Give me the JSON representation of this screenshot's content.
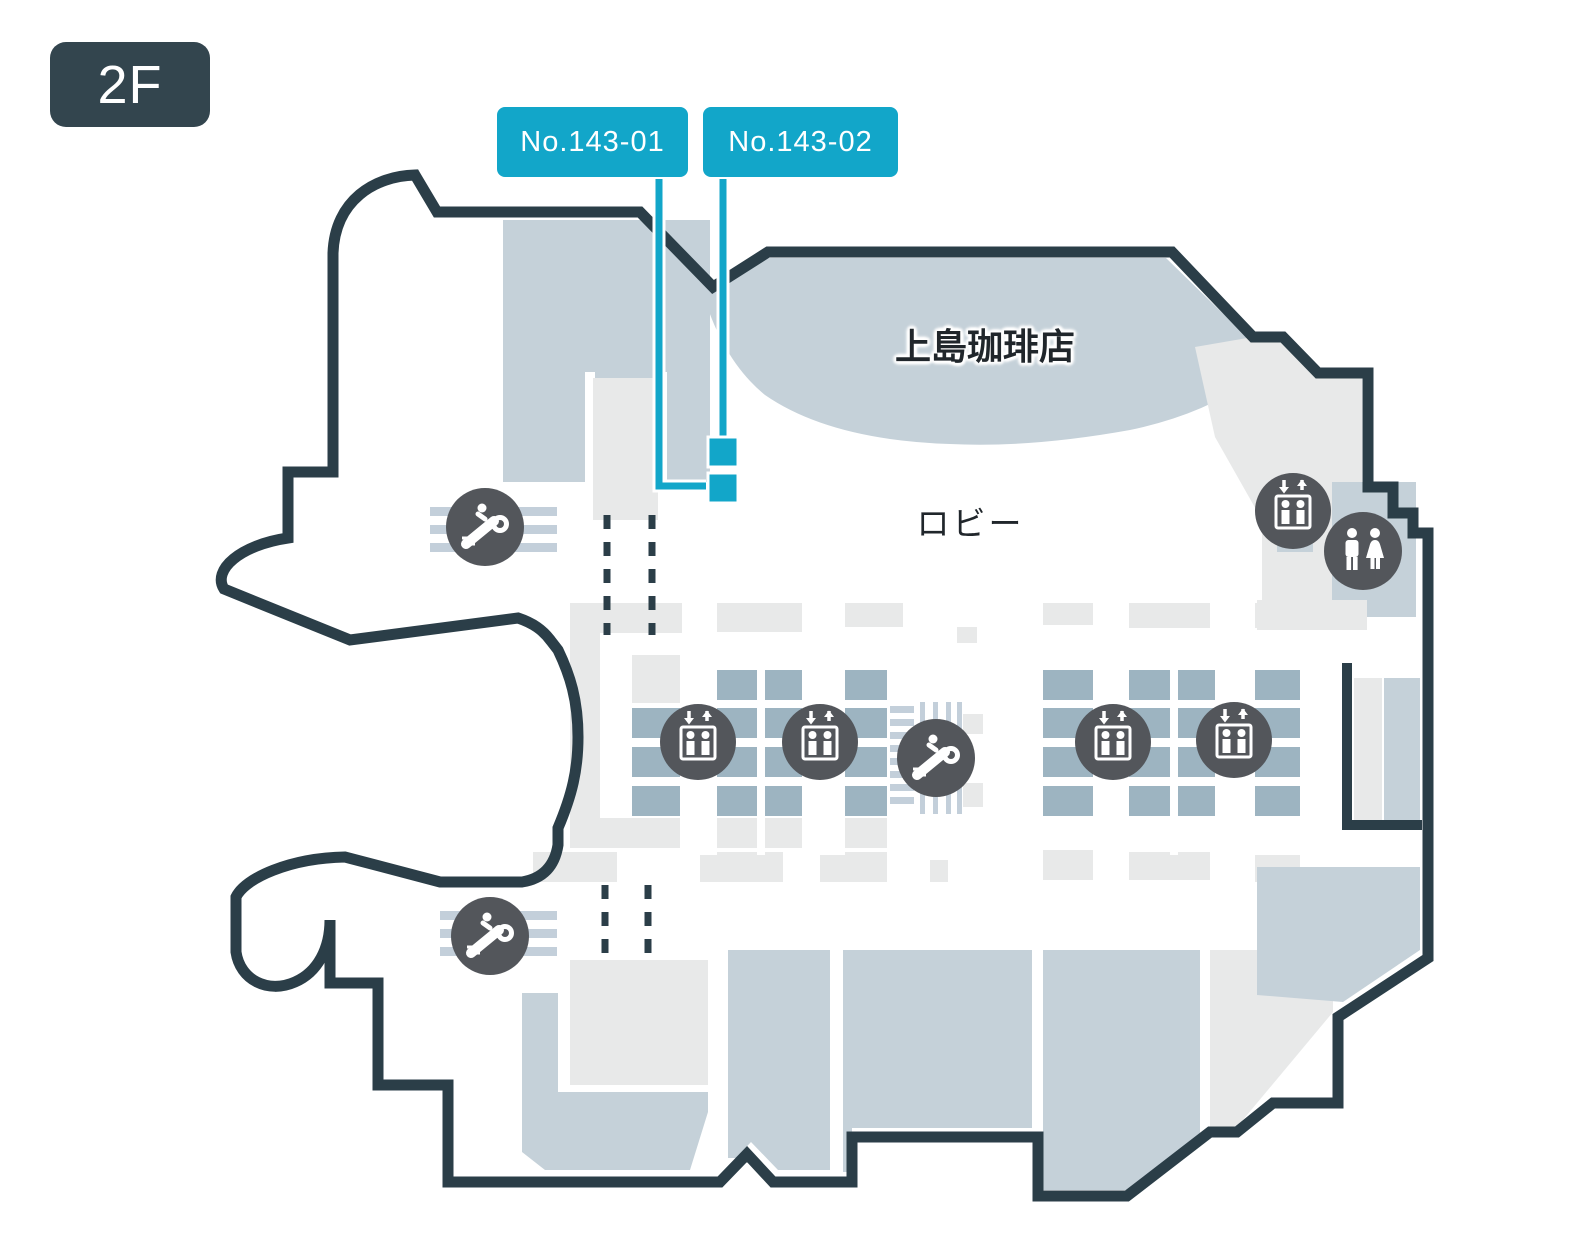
{
  "floor_badge": {
    "label": "2F"
  },
  "unit_markers": [
    {
      "id": "143-01",
      "label": "No.143-01"
    },
    {
      "id": "143-02",
      "label": "No.143-02"
    }
  ],
  "areas": {
    "coffee_shop_label": "上島珈琲店",
    "lobby_label": "ロビー"
  },
  "icons": {
    "elevator": "elevator-icon",
    "escalator": "escalator-icon",
    "restroom": "restroom-icon"
  },
  "colors": {
    "accent_cyan": "#12a6c9",
    "outline_dark": "#2b3e48",
    "area_blue_gray": "#c5d1d9",
    "grid_cell_blue": "#9db4c1",
    "area_light_gray": "#e8e9e9",
    "esc_bar": "#c3cfda",
    "icon_circle": "#53565b",
    "badge_bg": "#33454e"
  }
}
